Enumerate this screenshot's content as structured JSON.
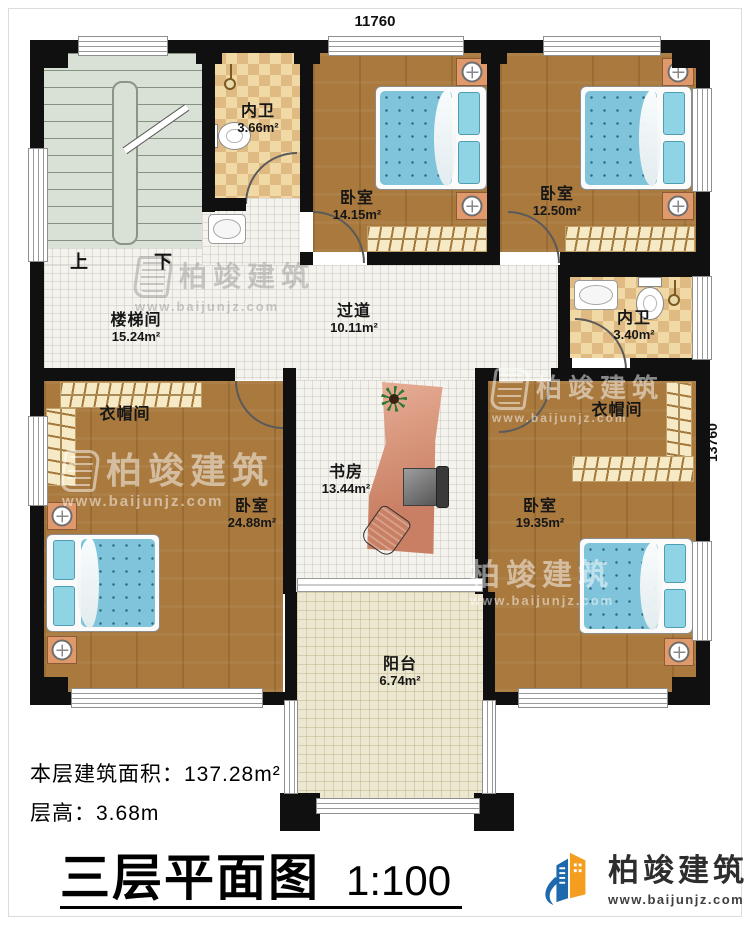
{
  "dimensions": {
    "top": "11760",
    "right": "13760"
  },
  "rooms": {
    "stairwell": {
      "name": "楼梯间",
      "area": "15.24m²",
      "up": "上",
      "down": "下"
    },
    "bath_top": {
      "name": "内卫",
      "area": "3.66m²"
    },
    "bedroom_top_mid": {
      "name": "卧室",
      "area": "14.15m²"
    },
    "bedroom_top_right": {
      "name": "卧室",
      "area": "12.50m²"
    },
    "corridor": {
      "name": "过道",
      "area": "10.11m²"
    },
    "bath_right": {
      "name": "内卫",
      "area": "3.40m²"
    },
    "cloak_left": {
      "name": "衣帽间"
    },
    "bedroom_left": {
      "name": "卧室",
      "area": "24.88m²"
    },
    "study": {
      "name": "书房",
      "area": "13.44m²"
    },
    "cloak_right": {
      "name": "衣帽间"
    },
    "bedroom_right": {
      "name": "卧室",
      "area": "19.35m²"
    },
    "balcony": {
      "name": "阳台",
      "area": "6.74m²"
    }
  },
  "stats": {
    "area_label": "本层建筑面积：",
    "area_value": "137.28m²",
    "height_label": "层高：",
    "height_value": "3.68m"
  },
  "title": {
    "text": "三层平面图",
    "scale": "1:100"
  },
  "brand": {
    "name": "柏竣建筑",
    "website": "www.baijunjz.com"
  },
  "watermark": {
    "name": "柏竣建筑",
    "website": "www.baijunjz.com"
  },
  "colors": {
    "wall": "#101010",
    "wood": "#a9793e",
    "corridor": "#f4f3ee",
    "stair": "#d9e0d6",
    "bathA": "#f1d9a6",
    "bathB": "#dfba83",
    "balcony": "#ece7d0",
    "mattress": "#7fc4da",
    "pillow": "#8fd4e4",
    "nightstand": "#e0996a",
    "wardrobe": "#f6e9c5",
    "brandBlue": "#1e68ad",
    "brandOrange": "#f59d1e"
  }
}
